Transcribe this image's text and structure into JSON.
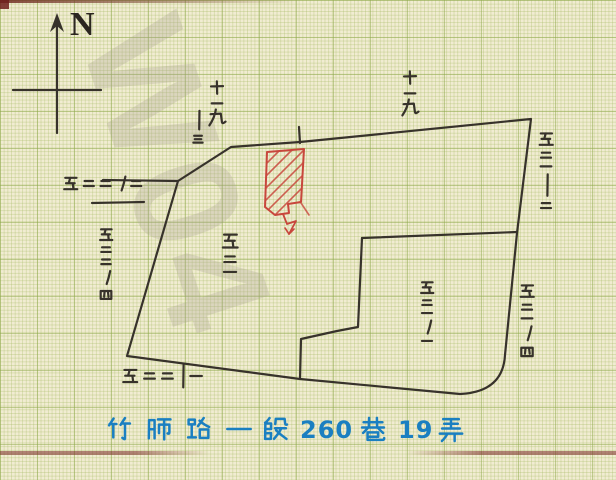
{
  "compass": {
    "label": "N"
  },
  "watermark": {
    "text": "W04"
  },
  "address": {
    "text": "竹師路一段 260 巷 19 弄",
    "parts": [
      "竹",
      "師",
      "路",
      "一",
      "段",
      "260",
      "巷",
      "19",
      "弄"
    ],
    "color": "#1a7fc1"
  },
  "lot_labels": [
    {
      "id": "lot-19-top-mid",
      "text": "十九",
      "reading": "19",
      "orientation": "vertical",
      "x": 217,
      "y": 80,
      "size": 19,
      "display": "十▁九"
    },
    {
      "id": "lot-slash-3",
      "text": "ノ三",
      "reading": "-3",
      "orientation": "vertical",
      "x": 198,
      "y": 110,
      "size": 13,
      "display": "丨三"
    },
    {
      "id": "lot-19-top-right",
      "text": "十九",
      "reading": "19",
      "orientation": "vertical",
      "x": 410,
      "y": 70,
      "size": 19,
      "display": "十▁九"
    },
    {
      "id": "lot-522-2",
      "text": "五二二ノ二",
      "reading": "522-2",
      "orientation": "horizontal",
      "x": 63,
      "y": 176,
      "size": 15
    },
    {
      "id": "lot-522-4",
      "text": "五二二ノ四",
      "reading": "522-4",
      "orientation": "vertical",
      "x": 106,
      "y": 228,
      "size": 14
    },
    {
      "id": "lot-521",
      "text": "五二一",
      "reading": "521",
      "orientation": "vertical",
      "x": 230,
      "y": 233,
      "size": 17
    },
    {
      "id": "lot-521-1",
      "text": "五二一ノ一",
      "reading": "521-1",
      "orientation": "vertical",
      "x": 427,
      "y": 281,
      "size": 14
    },
    {
      "id": "lot-521-2",
      "text": "五二一ノ二",
      "reading": "521-2",
      "orientation": "vertical",
      "x": 546,
      "y": 132,
      "size": 15,
      "display": "五二一丨二"
    },
    {
      "id": "lot-521-4",
      "text": "五二一ノ四",
      "reading": "521-4",
      "orientation": "vertical",
      "x": 527,
      "y": 284,
      "size": 15
    },
    {
      "id": "lot-522-1",
      "text": "五二二ノ一",
      "reading": "522-1",
      "orientation": "horizontal",
      "x": 122,
      "y": 368,
      "size": 16,
      "display": "五二二丨一"
    }
  ],
  "subject_parcel": {
    "style": "red-diagonal-hatch",
    "color": "#c8463c"
  },
  "colors": {
    "paper": "#f1ecd2",
    "grid_minor": "#a4ba62",
    "grid_major": "#8da84a",
    "ink": "#37322b",
    "red": "#c8463c",
    "blue": "#1a7fc1",
    "watermark": "#a8a292"
  }
}
